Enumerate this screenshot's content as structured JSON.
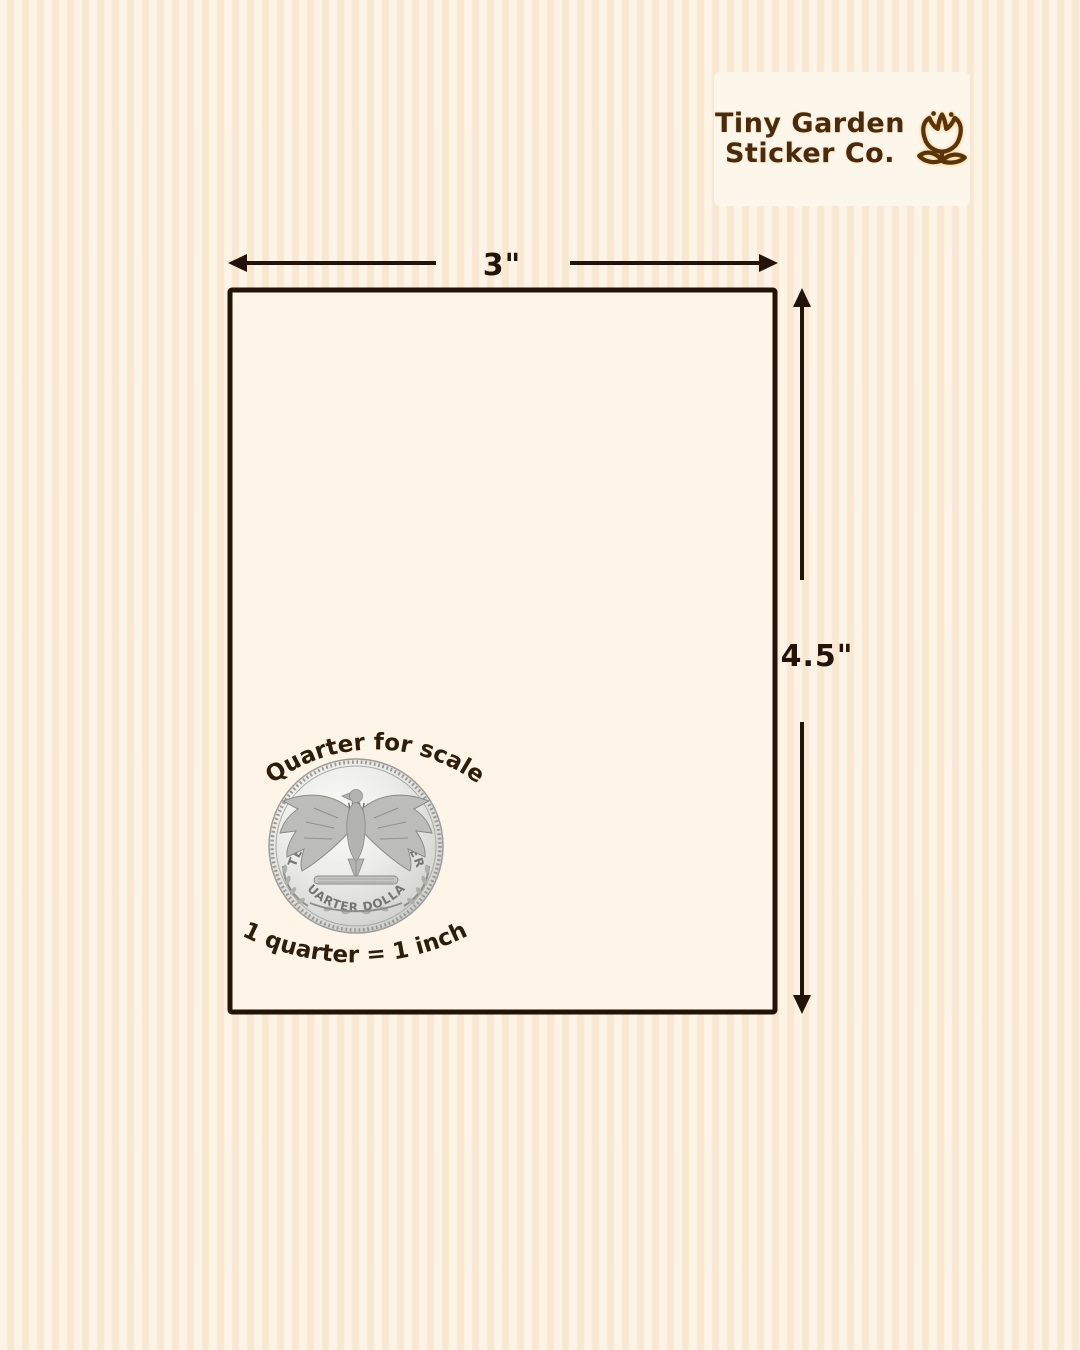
{
  "brand": {
    "name_line1": "Tiny Garden",
    "name_line2": "Sticker Co.",
    "icon": "tulip-flower-icon"
  },
  "size_diagram": {
    "width_label": "3\"",
    "height_label": "4.5\""
  },
  "scale_reference": {
    "caption_top": "Quarter for scale",
    "caption_bottom": "1 quarter = 1 inch",
    "coin": {
      "top_legend": "UNITED STATES OF AMERICA",
      "motto_line1": "E PLURIBUS",
      "motto_line2": "UNUM",
      "bottom_legend": "QUARTER DOLLAR"
    }
  },
  "colors": {
    "ink": "#241309",
    "stripe_light": "#FDF4E8",
    "stripe_dark": "#F8E7D1",
    "sticker_fill": "#FEF4E7",
    "badge_bg": "#FDF6EB",
    "logo_text": "#4A2A0C",
    "coin_silver": "#D8D8D4"
  }
}
